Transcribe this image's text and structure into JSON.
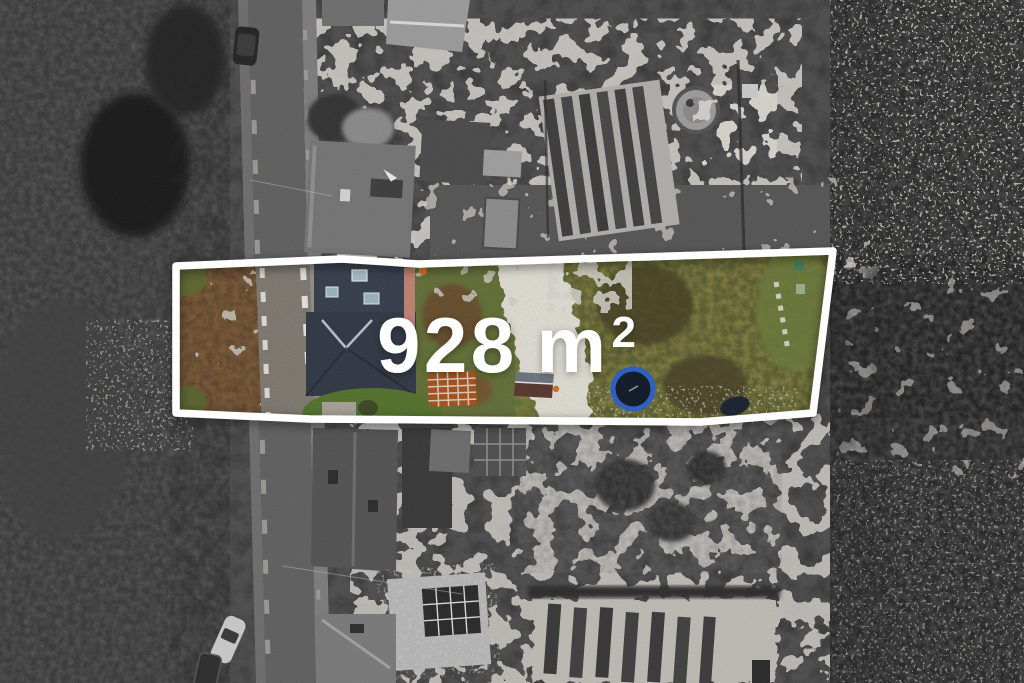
{
  "annotation": {
    "area_value": "928",
    "area_unit": "m",
    "area_superscript": "2",
    "full_label": "928 m²"
  },
  "colors": {
    "outline": "#ffffff",
    "label_text": "#ffffff",
    "plot_grass": "#64713a",
    "shrub_brown": "#7a5a3a",
    "road_asphalt": "#616161",
    "road_in_plot": "#7f7a72",
    "house_roof_slate": "#39414e",
    "skylight_blue": "#a8bcc6",
    "wall_pink": "#c08573",
    "orange_bed": "#a5541f",
    "shed_roof_gray": "#6e7780",
    "shed_roof_maroon": "#5a3a30",
    "trampoline_ring": "#2e62c4",
    "trampoline_mat": "#141d29",
    "snow": "#e6e3dc",
    "olive_branches": "#9a8c4a"
  }
}
